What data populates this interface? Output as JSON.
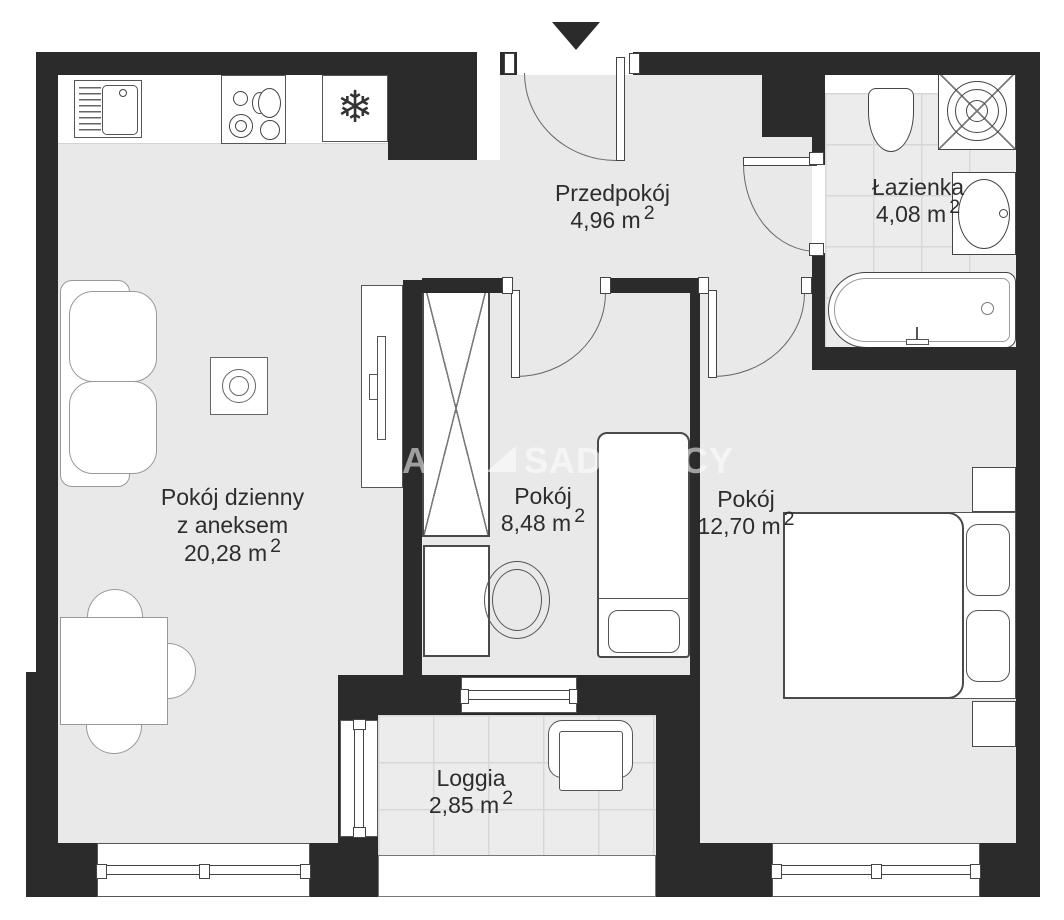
{
  "rooms": {
    "hall": {
      "name": "Przedpokój",
      "area": "4,96 m",
      "sup": "2"
    },
    "bath": {
      "name": "Łazienka",
      "area": "4,08 m",
      "sup": "2"
    },
    "living": {
      "name_line1": "Pokój dzienny",
      "name_line2": "z aneksem",
      "area": "20,28 m",
      "sup": "2"
    },
    "room_small": {
      "name": "Pokój",
      "area": "8,48 m",
      "sup": "2"
    },
    "room_big": {
      "name": "Pokój",
      "area": "12,70 m",
      "sup": "2"
    },
    "loggia": {
      "name": "Loggia",
      "area": "2,85 m",
      "sup": "2"
    }
  },
  "watermark": {
    "prefix_letter": "A",
    "brand": "SADURSCY"
  },
  "icons": {
    "fridge_snowflake": "❄"
  },
  "colors": {
    "wall": "#2b2b2b",
    "floor": "#e9e9e9",
    "tile": "#ececec",
    "tile_line": "#d7d7d7",
    "outline": "#4a4a4a",
    "outline_mid": "#555555",
    "outline_light": "#999999",
    "text": "#2d2d2d"
  }
}
